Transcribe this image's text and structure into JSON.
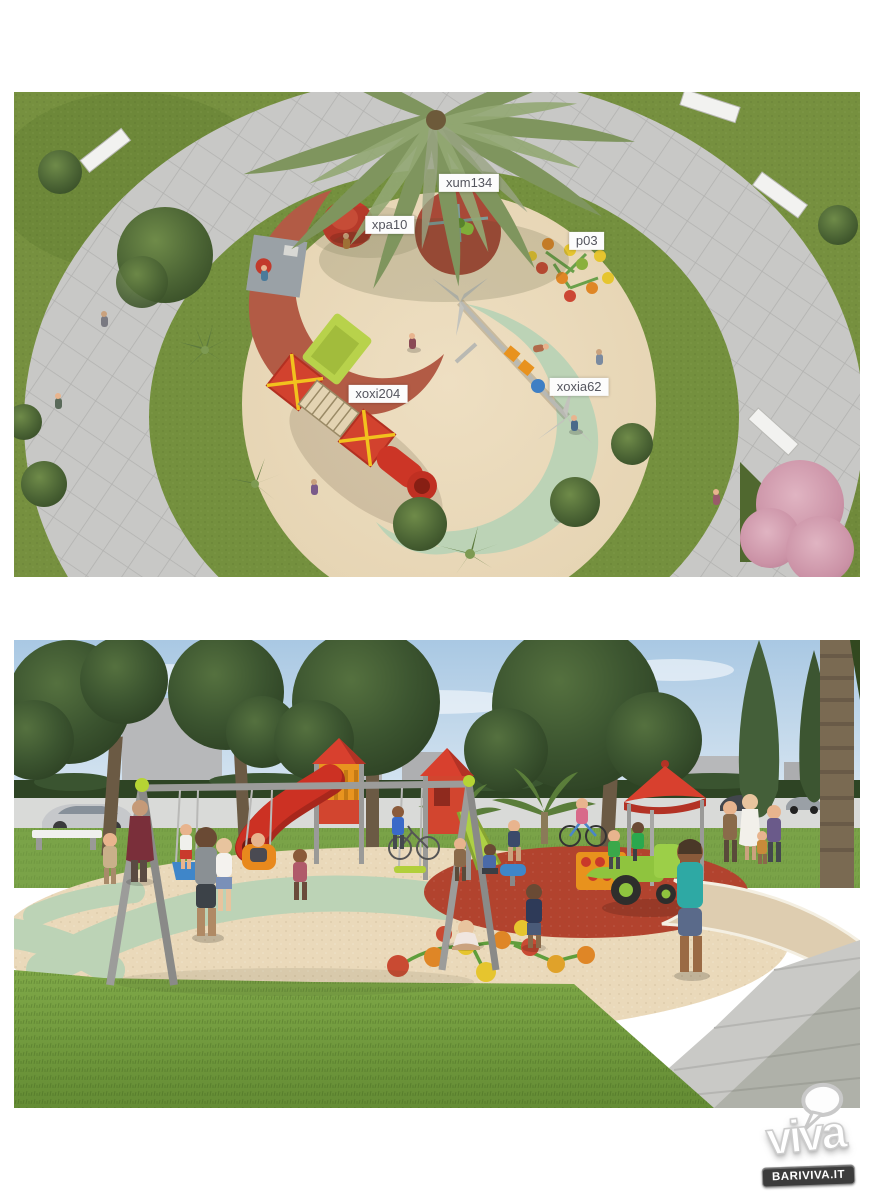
{
  "aerial_view": {
    "labels": [
      {
        "text": "xum134"
      },
      {
        "text": "xpa10"
      },
      {
        "text": "p03"
      },
      {
        "text": "xoxi204"
      },
      {
        "text": "xoxia62"
      }
    ]
  },
  "logo": {
    "brand": "viva",
    "site": "BARIVIVA.IT"
  },
  "colors": {
    "rubber_cream": "#ebdbbc",
    "rubber_terracotta": "#b25b45",
    "rubber_red": "#b2432e",
    "rubber_sage": "#bcd3b6",
    "grass": "#76903f",
    "pavement": "#c6c6c4",
    "equipment_red": "#d8402e",
    "equipment_orange": "#e8941f",
    "equipment_lime": "#b2cf3a",
    "sky": "#b3cfe6",
    "label_bg": "#fcfcfc",
    "label_text": "#54555e",
    "badge_bg": "#3c3c3c",
    "badge_text": "#ffffff"
  }
}
